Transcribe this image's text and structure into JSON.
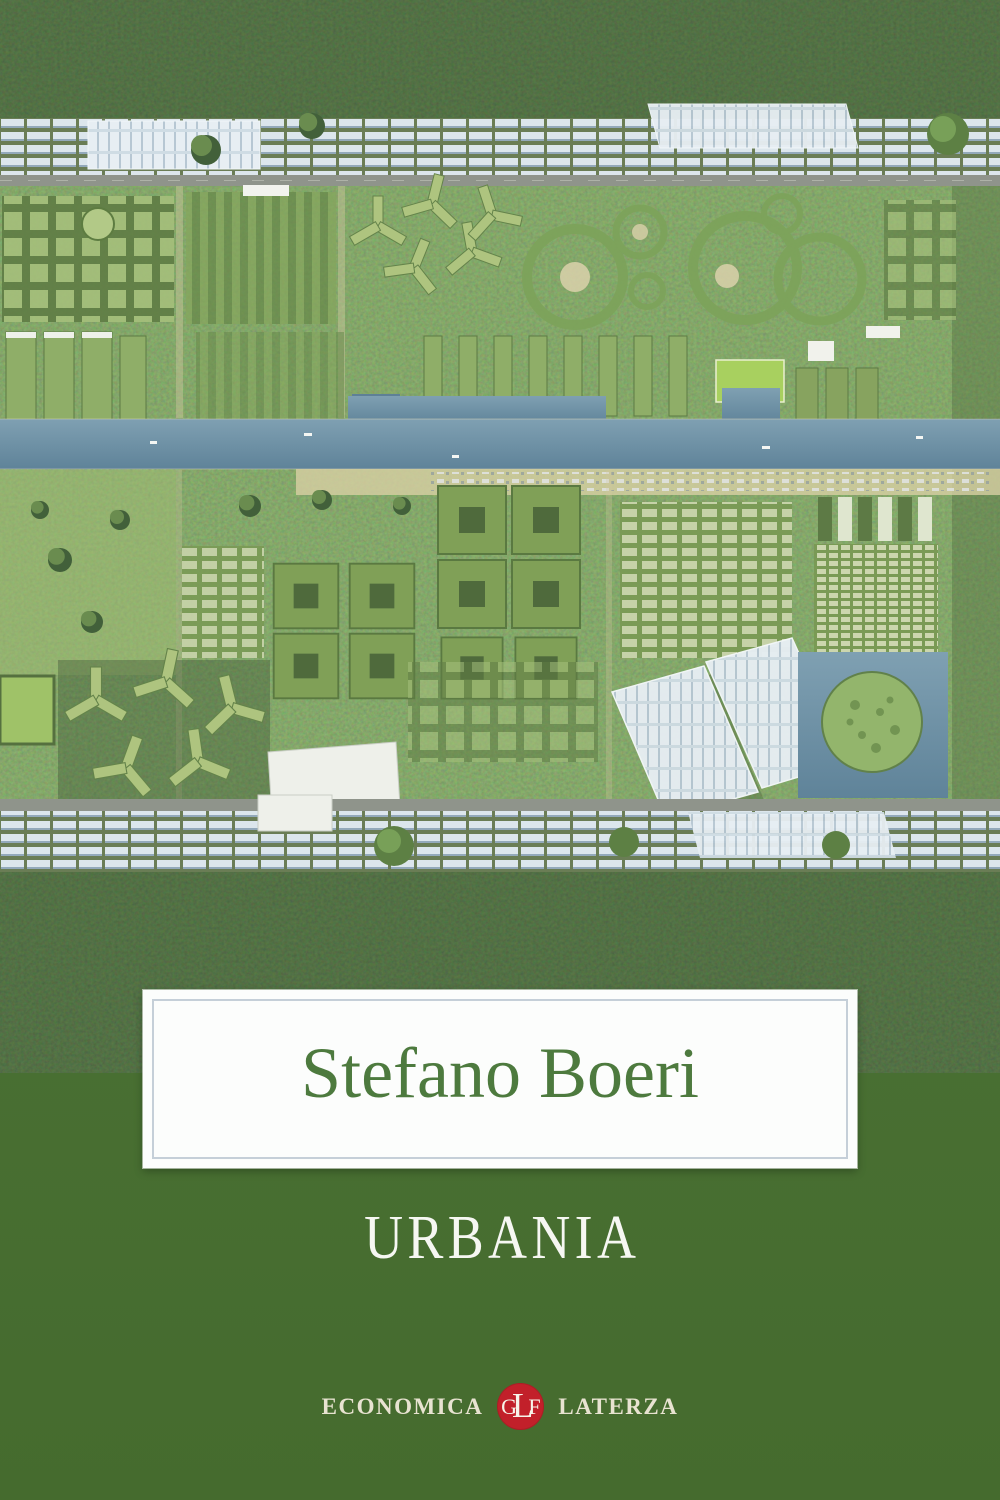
{
  "book_cover": {
    "author": "Stefano Boeri",
    "title": "URBANIA",
    "publisher": {
      "series": "ECONOMICA",
      "imprint": "LATERZA",
      "monogram": {
        "g": "G",
        "l": "L",
        "f": "F"
      }
    },
    "colors": {
      "band_green": "#4a7134",
      "author_green": "#4d7a3e",
      "title_white": "#f6f7f2",
      "logo_red": "#c2202a",
      "logo_text_cream": "#e8e3d1",
      "box_white": "#fcfdfc",
      "box_frame_gray_blue": "#c5cfd8",
      "canal_blue": "#6f93a8",
      "forest_dark_green": "#31492a"
    }
  }
}
